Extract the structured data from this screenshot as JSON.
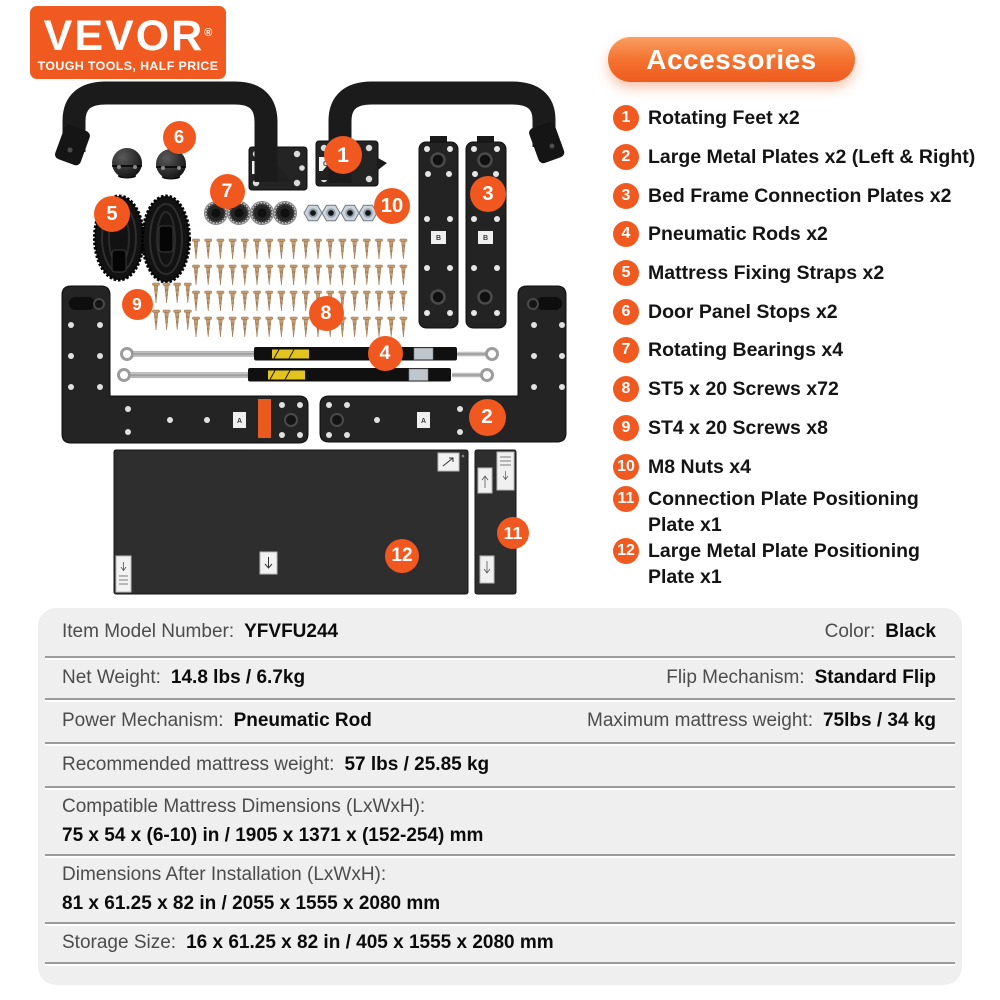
{
  "brand": {
    "name": "VEVOR",
    "registered": "®",
    "tagline": "TOUGH TOOLS, HALF PRICE"
  },
  "accessories": {
    "title": "Accessories",
    "items": [
      {
        "num": "1",
        "lines": [
          "Rotating Feet x2"
        ]
      },
      {
        "num": "2",
        "lines": [
          "Large Metal Plates x2 (Left & Right)"
        ]
      },
      {
        "num": "3",
        "lines": [
          "Bed Frame Connection Plates x2"
        ]
      },
      {
        "num": "4",
        "lines": [
          "Pneumatic Rods x2"
        ]
      },
      {
        "num": "5",
        "lines": [
          "Mattress Fixing Straps x2"
        ]
      },
      {
        "num": "6",
        "lines": [
          "Door Panel Stops x2"
        ]
      },
      {
        "num": "7",
        "lines": [
          "Rotating Bearings x4"
        ]
      },
      {
        "num": "8",
        "lines": [
          "ST5 x 20 Screws x72"
        ]
      },
      {
        "num": "9",
        "lines": [
          "ST4 x 20 Screws x8"
        ]
      },
      {
        "num": "10",
        "lines": [
          "M8 Nuts x4"
        ]
      },
      {
        "num": "11",
        "lines": [
          "Connection Plate Positioning",
          "Plate x1"
        ]
      },
      {
        "num": "12",
        "lines": [
          "Large Metal Plate Positioning",
          "Plate x1"
        ]
      }
    ]
  },
  "diagram": {
    "callouts": [
      {
        "n": "1",
        "x": 343,
        "y": 155,
        "d": 38
      },
      {
        "n": "2",
        "x": 487,
        "y": 417,
        "d": 37
      },
      {
        "n": "3",
        "x": 488,
        "y": 194,
        "d": 36
      },
      {
        "n": "4",
        "x": 385,
        "y": 353,
        "d": 35
      },
      {
        "n": "5",
        "x": 112,
        "y": 214,
        "d": 36
      },
      {
        "n": "6",
        "x": 179,
        "y": 137,
        "d": 33
      },
      {
        "n": "7",
        "x": 227,
        "y": 191,
        "d": 35
      },
      {
        "n": "8",
        "x": 326,
        "y": 313,
        "d": 35
      },
      {
        "n": "9",
        "x": 137,
        "y": 304,
        "d": 31
      },
      {
        "n": "10",
        "x": 392,
        "y": 206,
        "d": 36
      },
      {
        "n": "11",
        "x": 513,
        "y": 533,
        "d": 32
      },
      {
        "n": "12",
        "x": 402,
        "y": 556,
        "d": 34
      }
    ],
    "sticker_arm": "C",
    "sticker_connection": "B",
    "sticker_large": "A"
  },
  "specs": {
    "rows": [
      {
        "type": "pair",
        "left": {
          "label": "Item Model Number:",
          "value": "YFVFU244"
        },
        "right": {
          "label": "Color:",
          "value": "Black"
        }
      },
      {
        "type": "pair",
        "left": {
          "label": "Net Weight:",
          "value": "14.8 lbs / 6.7kg"
        },
        "right": {
          "label": "Flip Mechanism:",
          "value": "Standard Flip"
        }
      },
      {
        "type": "pair",
        "left": {
          "label": "Power Mechanism:",
          "value": "Pneumatic Rod"
        },
        "right": {
          "label": "Maximum mattress weight:",
          "value": "75lbs / 34 kg"
        }
      },
      {
        "type": "pair",
        "left": {
          "label": "Recommended mattress weight:",
          "value": "57 lbs / 25.85 kg"
        }
      },
      {
        "type": "stacked",
        "label": "Compatible Mattress Dimensions (LxWxH):",
        "value": "75 x 54 x (6-10) in / 1905 x 1371 x (152-254) mm"
      },
      {
        "type": "stacked",
        "label": "Dimensions After Installation (LxWxH):",
        "value": "81 x 61.25 x 82 in / 2055 x 1555 x 2080 mm"
      },
      {
        "type": "pair",
        "left": {
          "label": "Storage Size:",
          "value": "16 x 61.25 x 82 in / 405 x 1555 x 2080 mm"
        }
      }
    ]
  },
  "colors": {
    "brand_orange": "#F0591F",
    "pill_gradient_top": "#FA9E63",
    "pill_gradient_bottom": "#EE5A1F",
    "part_black": "#1B1B1B",
    "screw_bronze": "#C59C72",
    "card_gray": "#EFEFEF"
  }
}
